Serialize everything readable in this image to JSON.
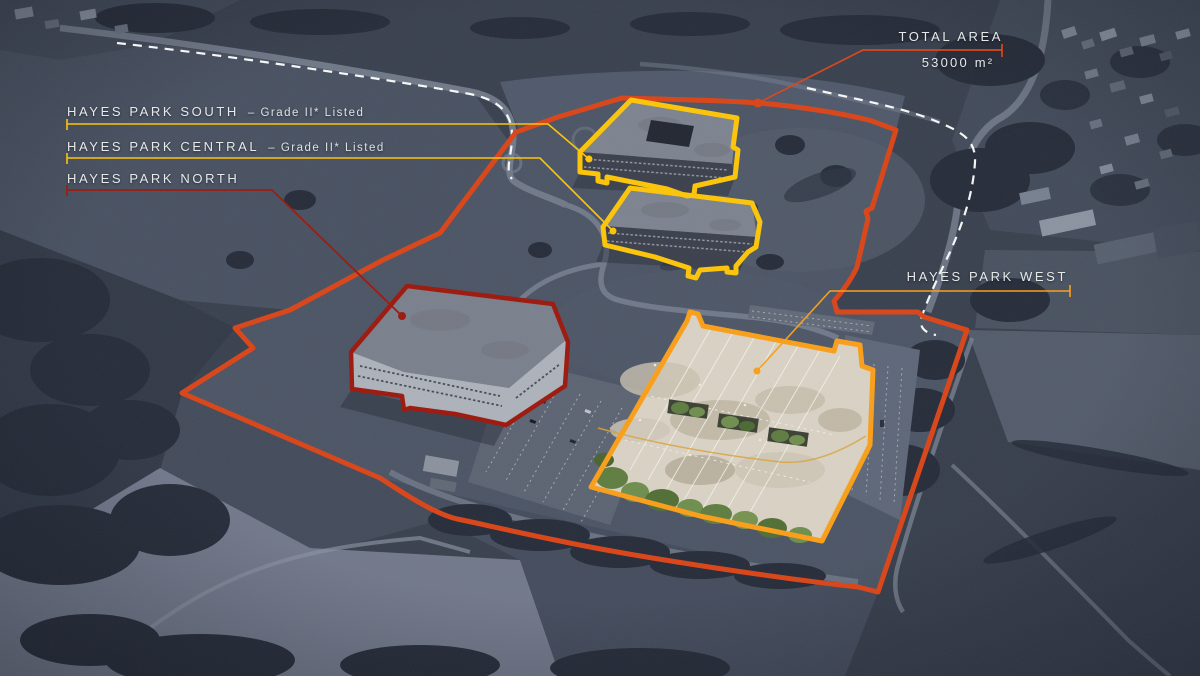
{
  "canvas": {
    "width": 1200,
    "height": 676
  },
  "areas": [
    {
      "id": "south",
      "label": "HAYES PARK SOUTH",
      "note": "– Grade II* Listed",
      "outline_color": "#FBC40D"
    },
    {
      "id": "central",
      "label": "HAYES PARK CENTRAL",
      "note": "– Grade II* Listed",
      "outline_color": "#FBC40D"
    },
    {
      "id": "north",
      "label": "HAYES PARK NORTH",
      "note": "",
      "outline_color": "#9E1D12"
    },
    {
      "id": "west",
      "label": "HAYES PARK WEST",
      "note": "",
      "outline_color": "#F8A01E"
    }
  ],
  "total_area": {
    "label": "TOTAL AREA",
    "value": "53000 m²"
  },
  "site": {
    "boundary_color": "#D9481D",
    "dashed_path_color": "#FFFFFF",
    "label_text_color": "#E7E9EA"
  }
}
